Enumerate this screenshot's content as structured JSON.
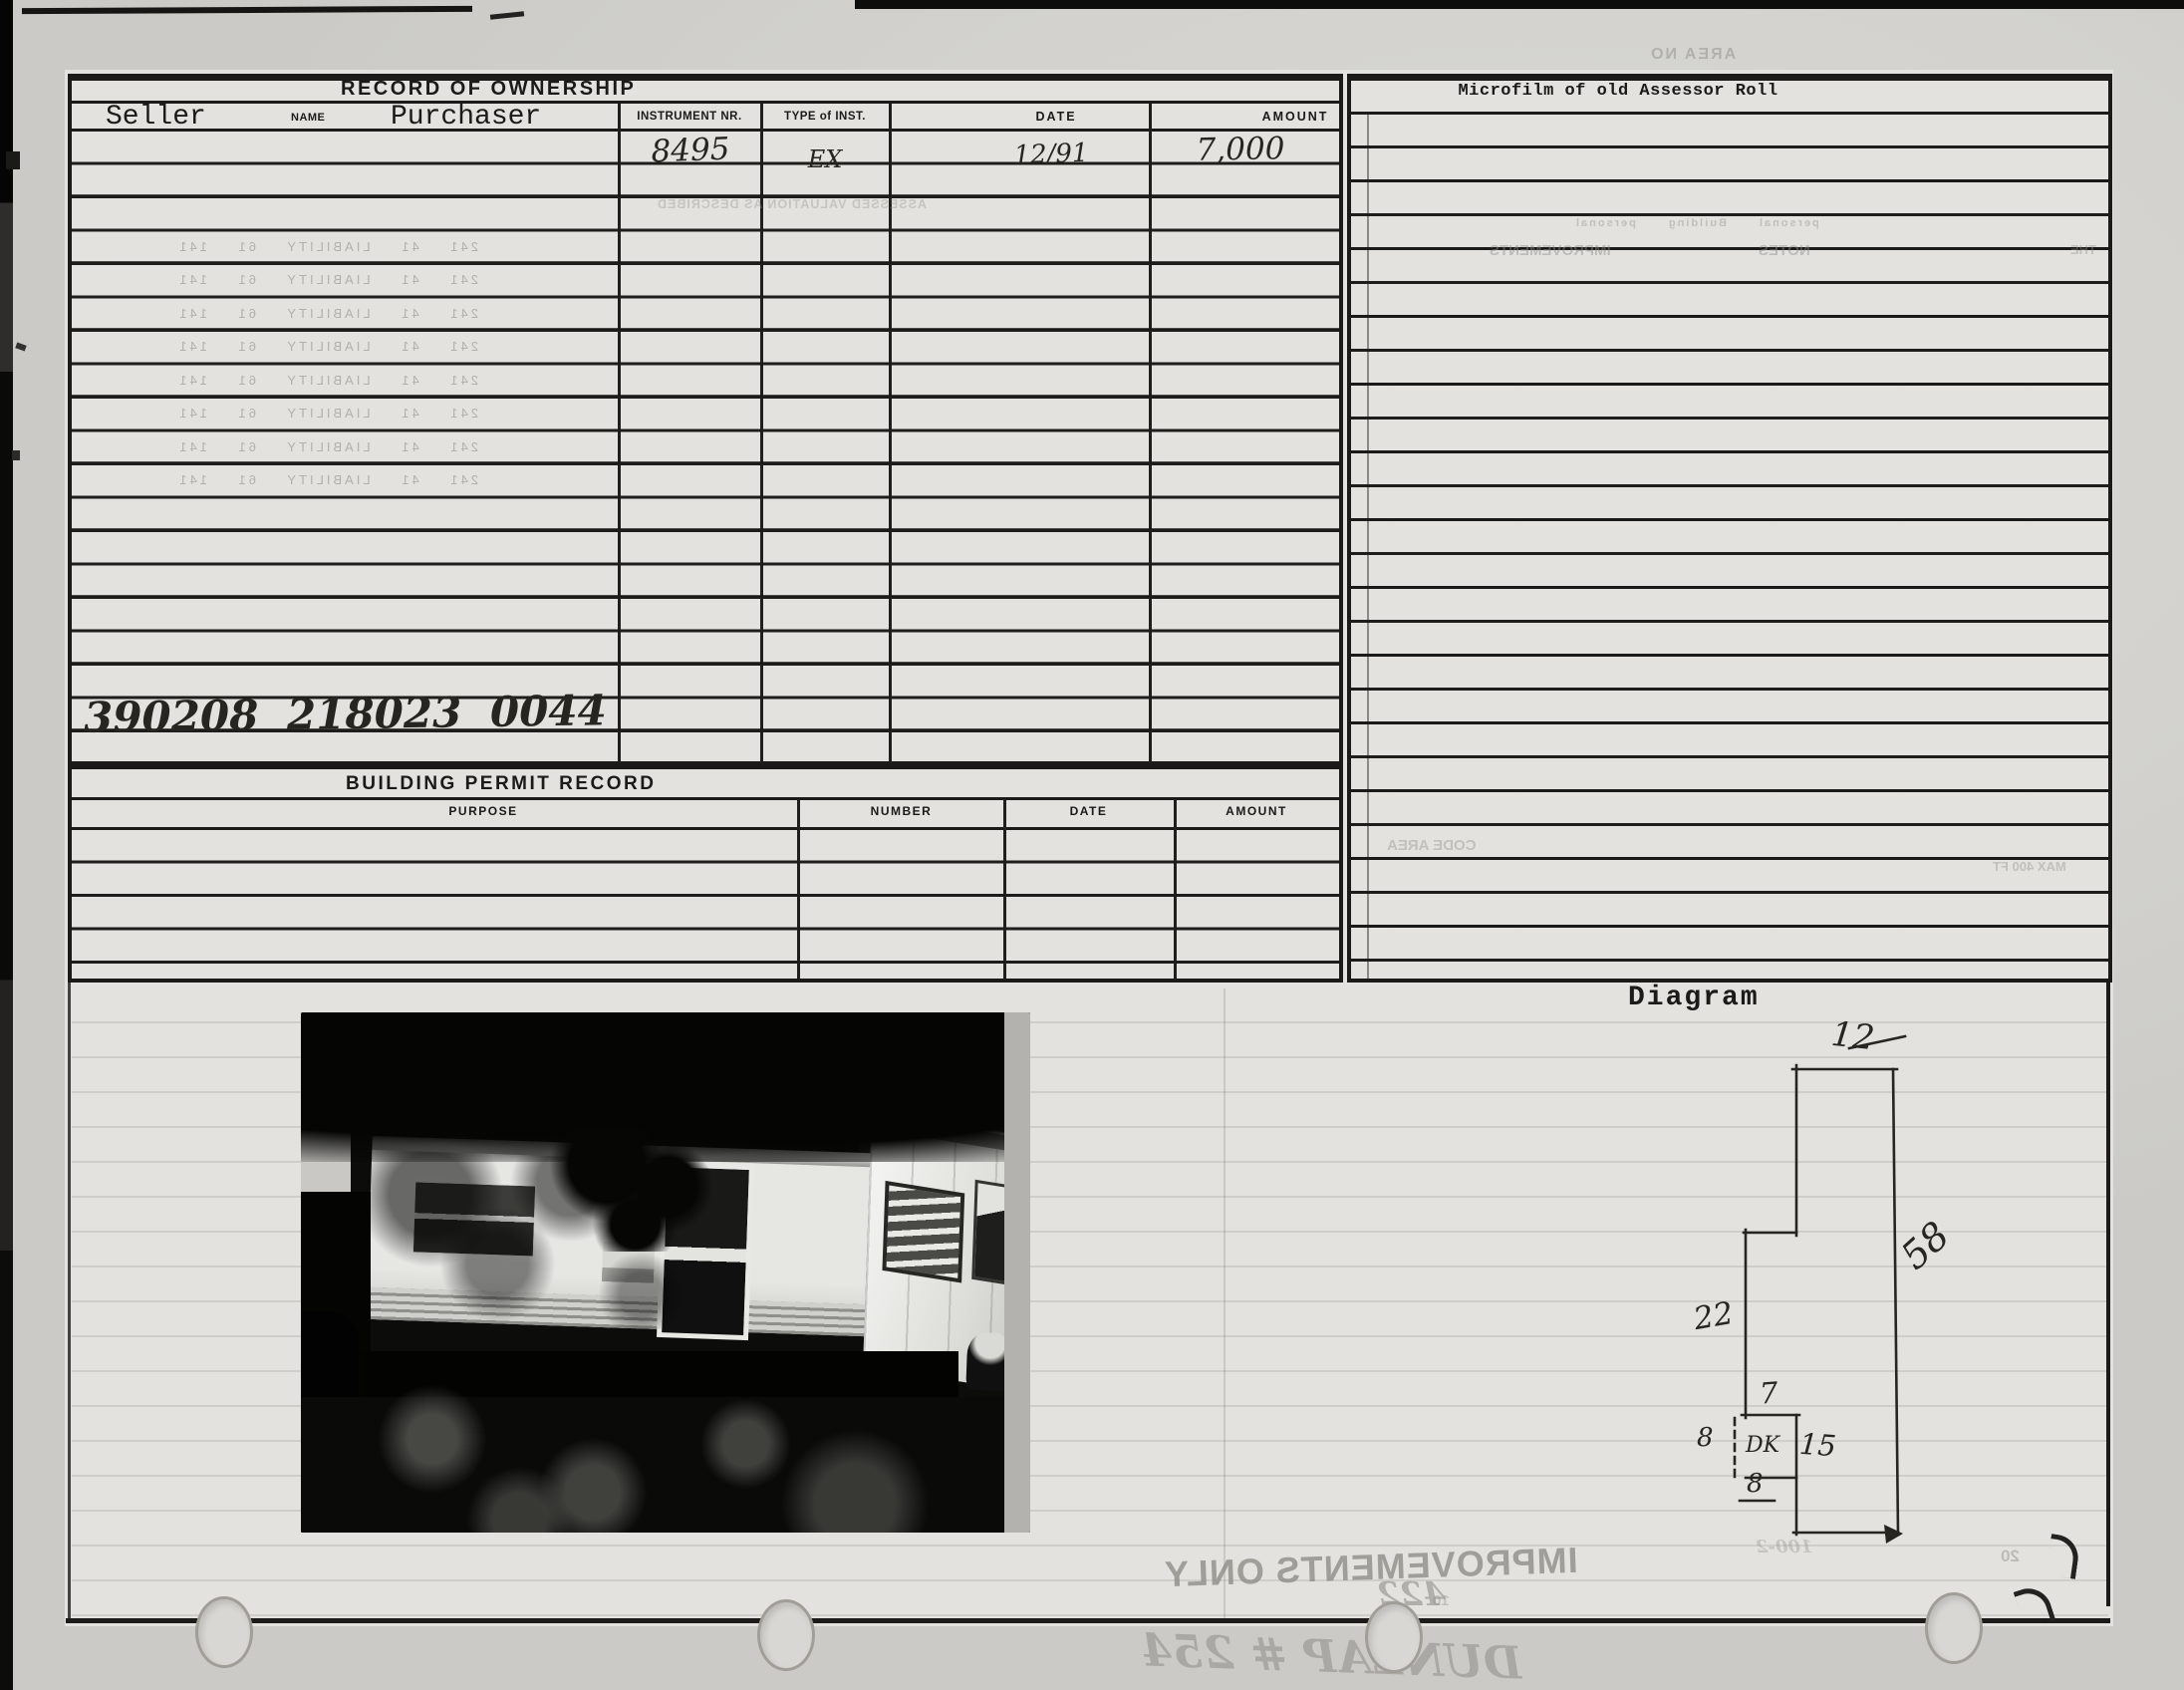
{
  "card": {
    "ownership": {
      "title": "RECORD OF OWNERSHIP",
      "seller_label": "Seller",
      "name_label": "NAME",
      "purchaser_label": "Purchaser",
      "instrument_label": "INSTRUMENT NR.",
      "type_label": "TYPE of INST.",
      "date_label": "DATE",
      "amount_label": "AMOUNT",
      "entry": {
        "instrument_nr": "8495",
        "type_of_inst": "EX",
        "date": "12/91",
        "amount": "7,000"
      },
      "parcel_number": "390208 218023 0044"
    },
    "building_permit": {
      "title": "BUILDING PERMIT RECORD",
      "purpose_label": "PURPOSE",
      "number_label": "NUMBER",
      "date_label": "DATE",
      "amount_label": "AMOUNT"
    },
    "microfilm": {
      "title": "Microfilm of old Assessor Roll"
    },
    "diagram": {
      "label": "Diagram",
      "top_width": "12",
      "right_height": "58",
      "left_height": "22",
      "step_width": "7",
      "deck_width": "8",
      "deck_bottom": "8",
      "deck_label": "DK",
      "deck_height": "15",
      "ghost_note": "100-2"
    }
  },
  "bleedthrough": {
    "area_no": "AREA NO",
    "ownership_line": "ASSESSED VALUATION AS DESCRIBED",
    "ledger_row": "241 41 LIABILITY 61 141",
    "mini_row": "personal Building personal",
    "notes": "NOTES",
    "improvements": "IMPROVEMENTS",
    "the": "THE",
    "code_area": "CODE AREA",
    "max_note": "MAX 400 FT",
    "improvements_only": "IMPROVEMENTS ONLY",
    "handwritten_name": "DUNLAP # 254",
    "num_422": "422",
    "num_20": "20",
    "num_10": "10"
  },
  "colors": {
    "ink": "#1b1a18",
    "paper": "#d3d2ce",
    "card": "#e3e2de",
    "ghost": "#8f8e89"
  }
}
